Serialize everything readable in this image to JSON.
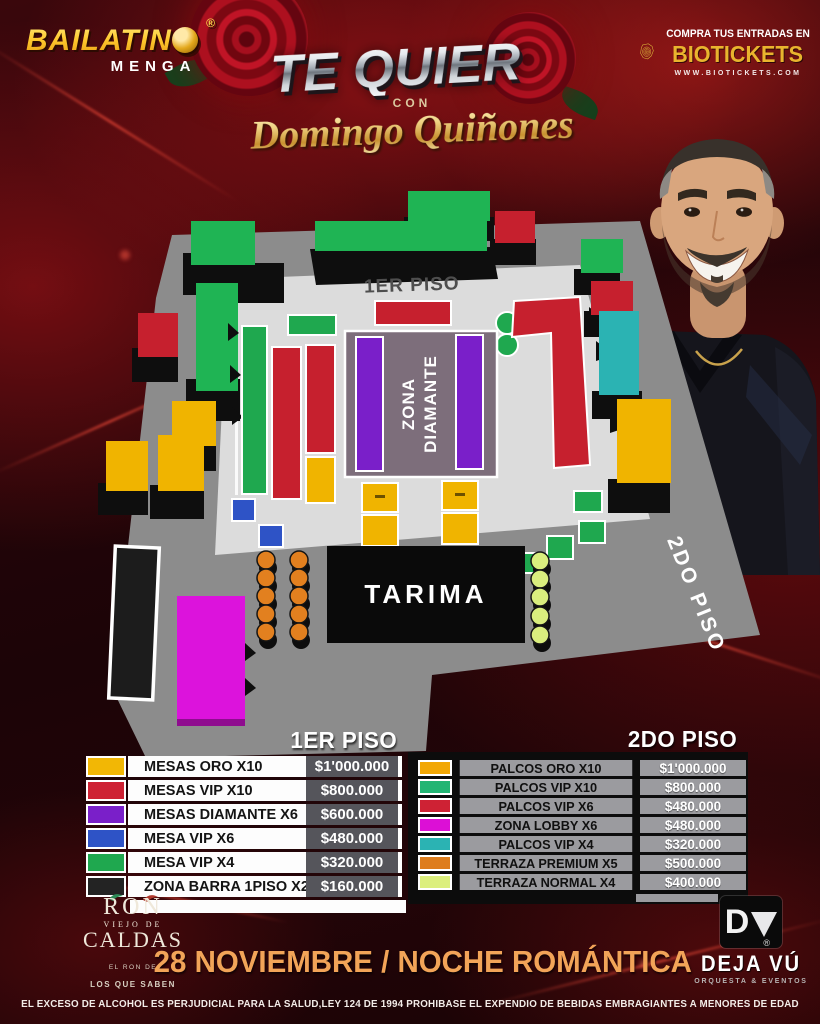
{
  "brand": {
    "name_head": "BAILATIN",
    "name_o": "O",
    "registered": "®",
    "sub": "MENGA"
  },
  "title": {
    "main": "TE QUIER",
    "heart": "♥",
    "con": "CON",
    "artist": "Domingo Quiñones"
  },
  "tickets": {
    "tagline": "COMPRA TUS ENTRADAS EN",
    "brand": "BIOTICKETS",
    "url": "WWW.BIOTICKETS.COM"
  },
  "map": {
    "floor1_label": "1ER PISO",
    "floor2_label": "2DO PISO",
    "diamante_line1": "ZONA",
    "diamante_line2": "DIAMANTE",
    "stage_label": "TARIMA"
  },
  "legend_floor1": {
    "header": "1ER PISO",
    "rows": [
      {
        "label": "MESAS ORO X10",
        "price": "$1'000.000",
        "color": "#F2B705"
      },
      {
        "label": "MESAS VIP X10",
        "price": "$800.000",
        "color": "#CE2234"
      },
      {
        "label": "MESAS DIAMANTE X6",
        "price": "$600.000",
        "color": "#7A1FC9"
      },
      {
        "label": "MESA VIP X6",
        "price": "$480.000",
        "color": "#2E53C6"
      },
      {
        "label": "MESA VIP X4",
        "price": "$320.000",
        "color": "#1FA84F"
      },
      {
        "label": "ZONA BARRA 1PISO X2",
        "price": "$160.000",
        "color": "#232323"
      }
    ]
  },
  "legend_floor2": {
    "header": "2DO PISO",
    "rows": [
      {
        "label": "PALCOS ORO X10",
        "price": "$1'000.000",
        "color": "#F2A705"
      },
      {
        "label": "PALCOS VIP X10",
        "price": "$800.000",
        "color": "#22B573"
      },
      {
        "label": "PALCOS VIP X6",
        "price": "$480.000",
        "color": "#CE2234"
      },
      {
        "label": "ZONA LOBBY X6",
        "price": "$480.000",
        "color": "#DC0FD6"
      },
      {
        "label": "PALCOS VIP X4",
        "price": "$320.000",
        "color": "#2BB3B3"
      },
      {
        "label": "TERRAZA PREMIUM X5",
        "price": "$500.000",
        "color": "#DE7D1E"
      },
      {
        "label": "TERRAZA NORMAL X4",
        "price": "$400.000",
        "color": "#DCEF7D"
      }
    ]
  },
  "footer": {
    "date_line": "28 NOVIEMBRE / NOCHE ROMÁNTICA",
    "legal": "EL EXCESO DE ALCOHOL ES PERJUDICIAL PARA LA SALUD,LEY 124 DE 1994 PROHIBASE EL EXPENDIO DE BEBIDAS EMBRAGIANTES A MENORES DE EDAD"
  },
  "sponsors": {
    "ron": {
      "line1": "RON",
      "line2": "VIEJO DE",
      "line3": "CALDAS",
      "tag1": "EL RON DE",
      "tag2": "LOS QUE SABEN"
    },
    "dejavu": {
      "initial": "D",
      "name": "DEJA VÚ",
      "registered": "®",
      "tagline": "ORQUESTA & EVENTOS"
    }
  }
}
